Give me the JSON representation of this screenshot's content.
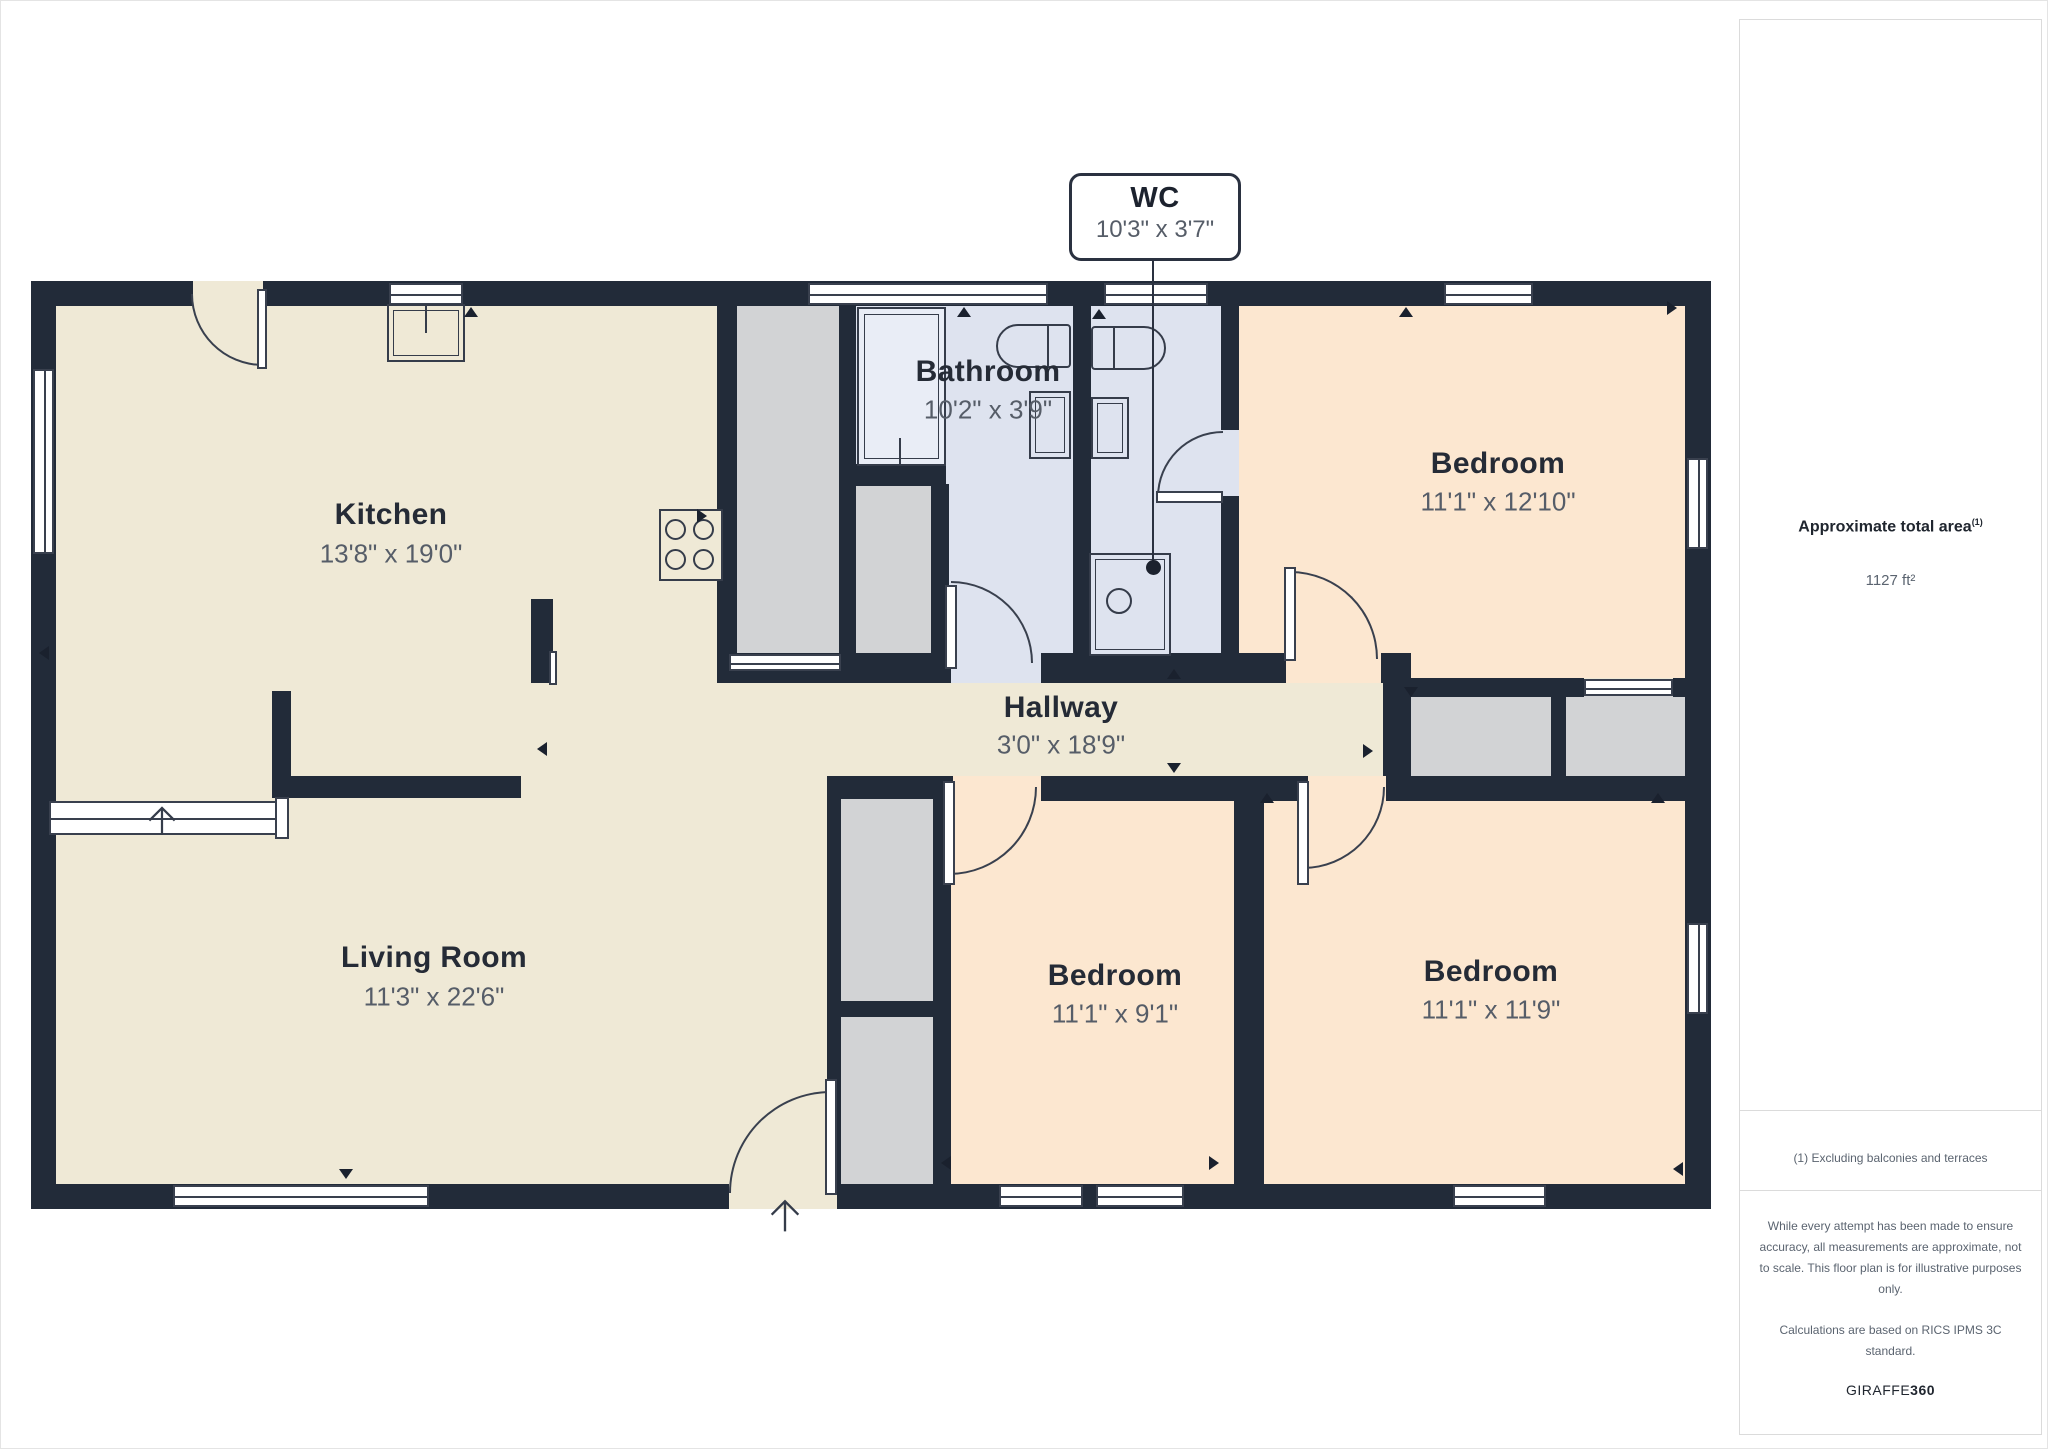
{
  "plan": {
    "rooms": {
      "kitchen": {
        "name": "Kitchen",
        "dims": "13'8\" x 19'0\""
      },
      "living_room": {
        "name": "Living Room",
        "dims": "11'3\" x 22'6\""
      },
      "hallway": {
        "name": "Hallway",
        "dims": "3'0\" x 18'9\""
      },
      "bathroom": {
        "name": "Bathroom",
        "dims": "10'2\" x 3'9\""
      },
      "bedroom_top_right": {
        "name": "Bedroom",
        "dims": "11'1\" x 12'10\""
      },
      "bedroom_bottom_middle": {
        "name": "Bedroom",
        "dims": "11'1\" x 9'1\""
      },
      "bedroom_bottom_right": {
        "name": "Bedroom",
        "dims": "11'1\" x 11'9\""
      }
    },
    "callout": {
      "name": "WC",
      "dims": "10'3\" x 3'7\""
    }
  },
  "sidebar": {
    "area_title": "Approximate total area",
    "area_footnote_marker": "(1)",
    "area_value": "1127 ft²",
    "footnote": "(1) Excluding balconies and terraces",
    "disclaimer": "While every attempt has been made to ensure accuracy, all measurements are approximate, not to scale. This floor plan is for illustrative purposes only.",
    "standard_note": "Calculations are based on RICS IPMS 3C standard.",
    "brand": "GIRAFFE",
    "brand_suffix": "360"
  },
  "colors": {
    "wall": "#222b39",
    "floor_main": "#efe9d6",
    "floor_bedroom": "#fce7d0",
    "floor_bath": "#dee3ef",
    "closet_gray": "#d2d3d5",
    "label_dark": "#252b36",
    "label_gray": "#565d68"
  }
}
